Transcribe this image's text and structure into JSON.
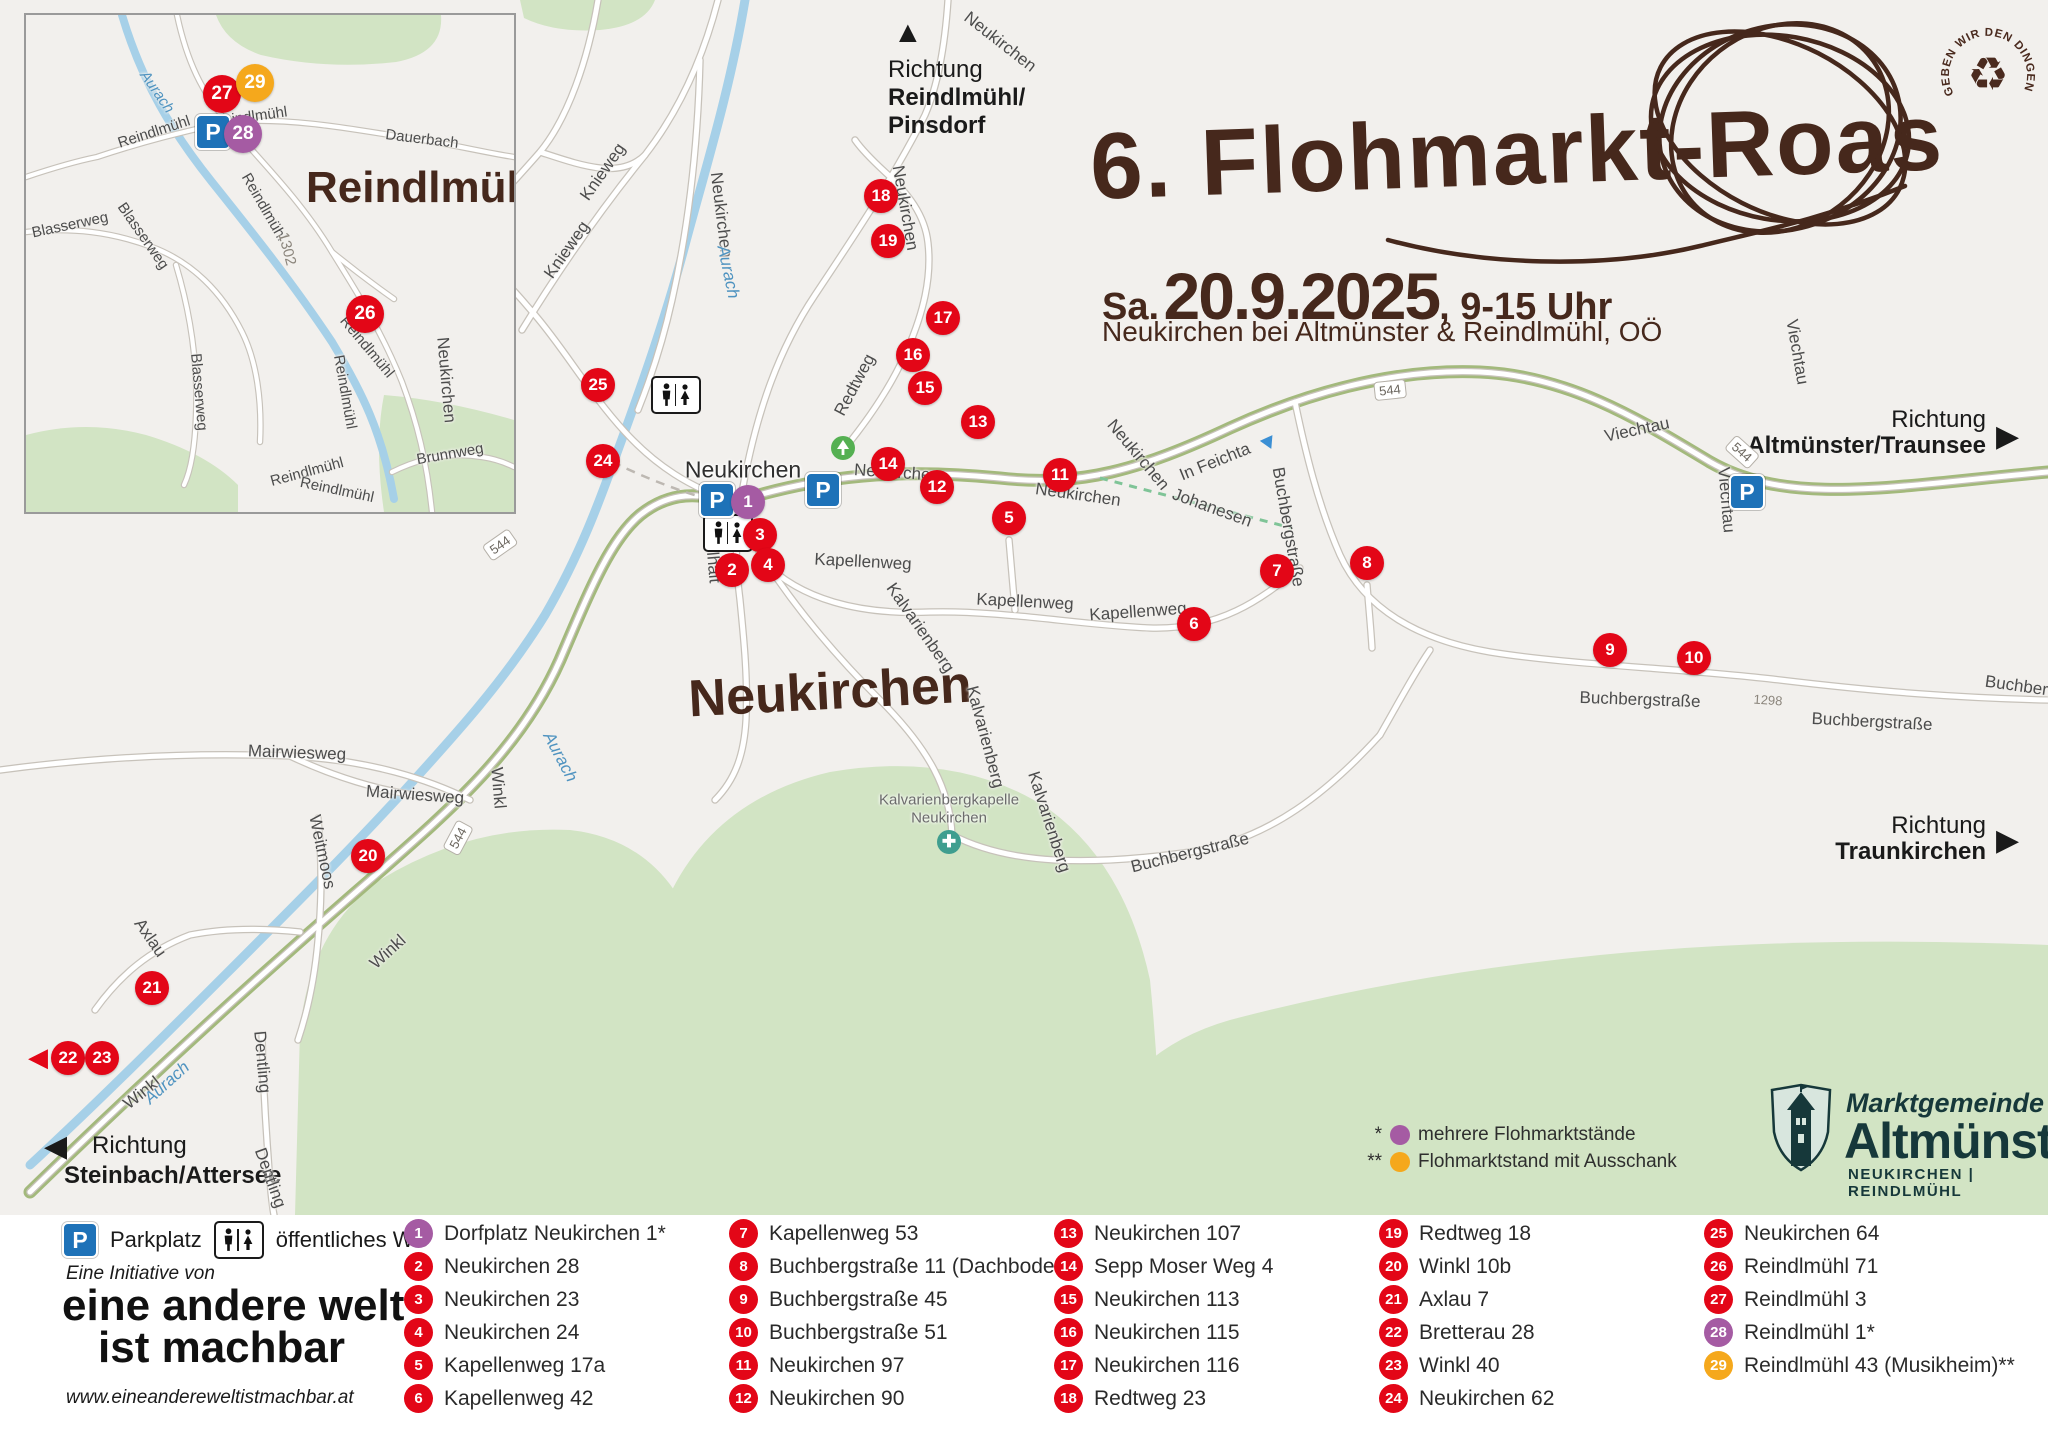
{
  "title": {
    "heading": "6. Flohmarkt-Roas",
    "date_prefix": "Sa.",
    "date": "20.9.2025",
    "time": ", 9-15 Uhr",
    "subtitle": "Neukirchen bei Altmünster & Reindlmühl, OÖ"
  },
  "stamp": {
    "text": "GEBEN WIR DEN DINGEN EIN 2. LEBEN",
    "symbol": "♻"
  },
  "icons": {
    "up": "▲",
    "right": "▶",
    "left": "◀"
  },
  "directions": {
    "north": {
      "line1": "Richtung",
      "line2": "Reindlmühl/",
      "line3": "Pinsdorf"
    },
    "east_top": {
      "line1": "Richtung",
      "line2": "Altmünster/Traunsee"
    },
    "east_mid": {
      "line1": "Richtung",
      "line2": "Traunkirchen"
    },
    "southwest": {
      "line1": "Richtung",
      "line2": "Steinbach/Attersee"
    }
  },
  "map": {
    "big_place": {
      "text": "Neukirchen",
      "x": 830,
      "y": 692
    },
    "place_labels": [
      {
        "t": "Neukirchen",
        "x": 743,
        "y": 470,
        "r": 0,
        "cls": "town"
      },
      {
        "t": "Kalvarienbergkapelle",
        "x": 949,
        "y": 800,
        "r": 0,
        "cls": "poi"
      },
      {
        "t": "Neukirchen",
        "x": 949,
        "y": 818,
        "r": 0,
        "cls": "poi"
      }
    ],
    "road_labels": [
      {
        "t": "Knieweg",
        "x": 567,
        "y": 250,
        "r": -55
      },
      {
        "t": "Knieweg",
        "x": 603,
        "y": 172,
        "r": -55
      },
      {
        "t": "Neukirchen",
        "x": 721,
        "y": 215,
        "r": 83
      },
      {
        "t": "Neukirchen",
        "x": 905,
        "y": 208,
        "r": 80
      },
      {
        "t": "Neukirchen",
        "x": 1000,
        "y": 42,
        "r": 38
      },
      {
        "t": "Neukirchen",
        "x": 446,
        "y": 380,
        "r": 85
      },
      {
        "t": "Neukirchen",
        "x": 897,
        "y": 473,
        "r": 4
      },
      {
        "t": "Neukirchen",
        "x": 1138,
        "y": 455,
        "r": 50
      },
      {
        "t": "Neukirchen",
        "x": 1078,
        "y": 495,
        "r": 8
      },
      {
        "t": "Redtweg",
        "x": 855,
        "y": 385,
        "r": -62
      },
      {
        "t": "In Feichta",
        "x": 1215,
        "y": 462,
        "r": -22
      },
      {
        "t": "Johanesen",
        "x": 1212,
        "y": 508,
        "r": 20
      },
      {
        "t": "Buchbergstraße",
        "x": 1288,
        "y": 527,
        "r": 80
      },
      {
        "t": "Kapellenweg",
        "x": 863,
        "y": 562,
        "r": 3
      },
      {
        "t": "Kapellenweg",
        "x": 1025,
        "y": 602,
        "r": 3
      },
      {
        "t": "Kapellenweg",
        "x": 1138,
        "y": 612,
        "r": -4
      },
      {
        "t": "Kalvarienberg",
        "x": 920,
        "y": 628,
        "r": 55
      },
      {
        "t": "Kalvarienberg",
        "x": 985,
        "y": 737,
        "r": 75
      },
      {
        "t": "Kalvarienberg",
        "x": 1049,
        "y": 822,
        "r": 72
      },
      {
        "t": "Kößlhalt",
        "x": 712,
        "y": 552,
        "r": 85
      },
      {
        "t": "Buchbergstraße",
        "x": 1190,
        "y": 853,
        "r": -14
      },
      {
        "t": "Buchbergstraße",
        "x": 1640,
        "y": 700,
        "r": 2
      },
      {
        "t": "Buchbergstraße",
        "x": 1872,
        "y": 722,
        "r": 3
      },
      {
        "t": "Buchbergstraße",
        "x": 2045,
        "y": 690,
        "r": 8
      },
      {
        "t": "Viechtau",
        "x": 1637,
        "y": 430,
        "r": -12
      },
      {
        "t": "Viechtau",
        "x": 1726,
        "y": 500,
        "r": 85
      },
      {
        "t": "Viechtau",
        "x": 1797,
        "y": 352,
        "r": 80
      },
      {
        "t": "Winkl",
        "x": 498,
        "y": 788,
        "r": 85
      },
      {
        "t": "Winkl",
        "x": 388,
        "y": 952,
        "r": -42
      },
      {
        "t": "Winkl",
        "x": 142,
        "y": 1093,
        "r": -38
      },
      {
        "t": "Weitmoos",
        "x": 322,
        "y": 852,
        "r": 78
      },
      {
        "t": "Axlau",
        "x": 150,
        "y": 938,
        "r": 55
      },
      {
        "t": "Mairwiesweg",
        "x": 297,
        "y": 753,
        "r": 2
      },
      {
        "t": "Mairwiesweg",
        "x": 415,
        "y": 795,
        "r": 4
      },
      {
        "t": "Dentling",
        "x": 262,
        "y": 1062,
        "r": 85
      },
      {
        "t": "Dentling",
        "x": 270,
        "y": 1178,
        "r": 70
      },
      {
        "t": "1298",
        "x": 1768,
        "y": 700,
        "r": 4,
        "cls": "ref"
      }
    ],
    "river_labels": [
      {
        "t": "Aurach",
        "x": 728,
        "y": 272,
        "r": 78
      },
      {
        "t": "Aurach",
        "x": 560,
        "y": 757,
        "r": 62
      },
      {
        "t": "Aurach",
        "x": 167,
        "y": 1083,
        "r": -42
      }
    ],
    "shields": [
      {
        "t": "544",
        "x": 500,
        "y": 545,
        "r": -35
      },
      {
        "t": "544",
        "x": 458,
        "y": 838,
        "r": -62
      },
      {
        "t": "544",
        "x": 1390,
        "y": 390,
        "r": -6
      },
      {
        "t": "544",
        "x": 1742,
        "y": 452,
        "r": 42
      }
    ],
    "markers": [
      {
        "n": "1",
        "x": 748,
        "y": 502,
        "c": "purple"
      },
      {
        "n": "2",
        "x": 732,
        "y": 570,
        "c": "red"
      },
      {
        "n": "3",
        "x": 760,
        "y": 535,
        "c": "red"
      },
      {
        "n": "4",
        "x": 768,
        "y": 565,
        "c": "red"
      },
      {
        "n": "5",
        "x": 1009,
        "y": 518,
        "c": "red"
      },
      {
        "n": "6",
        "x": 1194,
        "y": 624,
        "c": "red"
      },
      {
        "n": "7",
        "x": 1277,
        "y": 571,
        "c": "red"
      },
      {
        "n": "8",
        "x": 1367,
        "y": 563,
        "c": "red"
      },
      {
        "n": "9",
        "x": 1610,
        "y": 650,
        "c": "red"
      },
      {
        "n": "10",
        "x": 1694,
        "y": 658,
        "c": "red"
      },
      {
        "n": "11",
        "x": 1060,
        "y": 475,
        "c": "red"
      },
      {
        "n": "12",
        "x": 937,
        "y": 487,
        "c": "red"
      },
      {
        "n": "13",
        "x": 978,
        "y": 422,
        "c": "red"
      },
      {
        "n": "14",
        "x": 888,
        "y": 464,
        "c": "red"
      },
      {
        "n": "15",
        "x": 925,
        "y": 388,
        "c": "red"
      },
      {
        "n": "16",
        "x": 913,
        "y": 355,
        "c": "red"
      },
      {
        "n": "17",
        "x": 943,
        "y": 318,
        "c": "red"
      },
      {
        "n": "18",
        "x": 881,
        "y": 196,
        "c": "red"
      },
      {
        "n": "19",
        "x": 888,
        "y": 241,
        "c": "red"
      },
      {
        "n": "20",
        "x": 368,
        "y": 856,
        "c": "red"
      },
      {
        "n": "21",
        "x": 152,
        "y": 988,
        "c": "red"
      },
      {
        "n": "22",
        "x": 68,
        "y": 1058,
        "c": "red"
      },
      {
        "n": "23",
        "x": 102,
        "y": 1058,
        "c": "red"
      },
      {
        "n": "24",
        "x": 603,
        "y": 461,
        "c": "red"
      },
      {
        "n": "25",
        "x": 598,
        "y": 385,
        "c": "red"
      }
    ],
    "parking": [
      {
        "x": 717,
        "y": 500
      },
      {
        "x": 823,
        "y": 490
      },
      {
        "x": 1747,
        "y": 492
      }
    ],
    "wc": [
      {
        "x": 676,
        "y": 395
      },
      {
        "x": 728,
        "y": 533
      }
    ],
    "legend_notes": [
      {
        "star": "*",
        "label": "mehrere Flohmarktstände",
        "color": "#a55ba3"
      },
      {
        "star": "**",
        "label": "Flohmarktstand mit Ausschank",
        "color": "#f5a81c"
      }
    ]
  },
  "inset": {
    "title": "Reindlmühl",
    "road_labels": [
      {
        "t": "Reindlmühl",
        "x": 128,
        "y": 117,
        "r": -18
      },
      {
        "t": "Reindlmühl",
        "x": 238,
        "y": 192,
        "r": 60
      },
      {
        "t": "Reindlmühl",
        "x": 224,
        "y": 102,
        "r": -8
      },
      {
        "t": "Reindlmühl",
        "x": 341,
        "y": 332,
        "r": 50
      },
      {
        "t": "Reindlmühl",
        "x": 319,
        "y": 377,
        "r": 80
      },
      {
        "t": "Reindlmühl",
        "x": 281,
        "y": 457,
        "r": -15
      },
      {
        "t": "Reindlmühl",
        "x": 311,
        "y": 475,
        "r": 12
      },
      {
        "t": "Dauerbach",
        "x": 396,
        "y": 124,
        "r": 7
      },
      {
        "t": "Blasserweg",
        "x": 44,
        "y": 210,
        "r": -12
      },
      {
        "t": "Blasserweg",
        "x": 117,
        "y": 221,
        "r": 55
      },
      {
        "t": "Blasserweg",
        "x": 173,
        "y": 377,
        "r": 85
      },
      {
        "t": "Brunnweg",
        "x": 424,
        "y": 439,
        "r": -10
      },
      {
        "t": "1302",
        "x": 261,
        "y": 234,
        "r": 75,
        "cls": "ref"
      }
    ],
    "river_labels": [
      {
        "t": "Aurach",
        "x": 131,
        "y": 77,
        "r": 55
      }
    ],
    "markers": [
      {
        "n": "26",
        "x": 339,
        "y": 299,
        "c": "red"
      },
      {
        "n": "27",
        "x": 196,
        "y": 79,
        "c": "red"
      },
      {
        "n": "28",
        "x": 217,
        "y": 119,
        "c": "purple"
      },
      {
        "n": "29",
        "x": 229,
        "y": 68,
        "c": "orange"
      }
    ],
    "parking": [
      {
        "x": 187,
        "y": 117
      }
    ]
  },
  "municipality": {
    "line1": "Marktgemeinde",
    "name": "Altmünster",
    "sub": "NEUKIRCHEN | REINDLMÜHL"
  },
  "initiative": {
    "label": "Eine Initiative von",
    "name_line1": "eine andere welt",
    "name_line2": "ist machbar",
    "url": "www.eineandereweltistmachbar.at"
  },
  "amenity_legend": {
    "parking": "Parkplatz",
    "wc": "öffentliches WC"
  },
  "legend_items": [
    {
      "n": "1",
      "label": "Dorfplatz Neukirchen 1*",
      "c": "purple"
    },
    {
      "n": "2",
      "label": "Neukirchen 28",
      "c": "red"
    },
    {
      "n": "3",
      "label": "Neukirchen 23",
      "c": "red"
    },
    {
      "n": "4",
      "label": "Neukirchen 24",
      "c": "red"
    },
    {
      "n": "5",
      "label": "Kapellenweg 17a",
      "c": "red"
    },
    {
      "n": "6",
      "label": "Kapellenweg 42",
      "c": "red"
    },
    {
      "n": "7",
      "label": "Kapellenweg 53",
      "c": "red"
    },
    {
      "n": "8",
      "label": "Buchbergstraße 11 (Dachboden)",
      "c": "red"
    },
    {
      "n": "9",
      "label": "Buchbergstraße 45",
      "c": "red"
    },
    {
      "n": "10",
      "label": "Buchbergstraße 51",
      "c": "red"
    },
    {
      "n": "11",
      "label": "Neukirchen 97",
      "c": "red"
    },
    {
      "n": "12",
      "label": "Neukirchen 90",
      "c": "red"
    },
    {
      "n": "13",
      "label": "Neukirchen 107",
      "c": "red"
    },
    {
      "n": "14",
      "label": "Sepp Moser Weg 4",
      "c": "red"
    },
    {
      "n": "15",
      "label": "Neukirchen 113",
      "c": "red"
    },
    {
      "n": "16",
      "label": "Neukirchen 115",
      "c": "red"
    },
    {
      "n": "17",
      "label": "Neukirchen 116",
      "c": "red"
    },
    {
      "n": "18",
      "label": "Redtweg 23",
      "c": "red"
    },
    {
      "n": "19",
      "label": "Redtweg 18",
      "c": "red"
    },
    {
      "n": "20",
      "label": "Winkl 10b",
      "c": "red"
    },
    {
      "n": "21",
      "label": "Axlau 7",
      "c": "red"
    },
    {
      "n": "22",
      "label": "Bretterau 28",
      "c": "red"
    },
    {
      "n": "23",
      "label": "Winkl 40",
      "c": "red"
    },
    {
      "n": "24",
      "label": "Neukirchen 62",
      "c": "red"
    },
    {
      "n": "25",
      "label": "Neukirchen 64",
      "c": "red"
    },
    {
      "n": "26",
      "label": "Reindlmühl 71",
      "c": "red"
    },
    {
      "n": "27",
      "label": "Reindlmühl 3",
      "c": "red"
    },
    {
      "n": "28",
      "label": "Reindlmühl 1*",
      "c": "purple"
    },
    {
      "n": "29",
      "label": "Reindlmühl 43 (Musikheim)**",
      "c": "orange"
    }
  ]
}
